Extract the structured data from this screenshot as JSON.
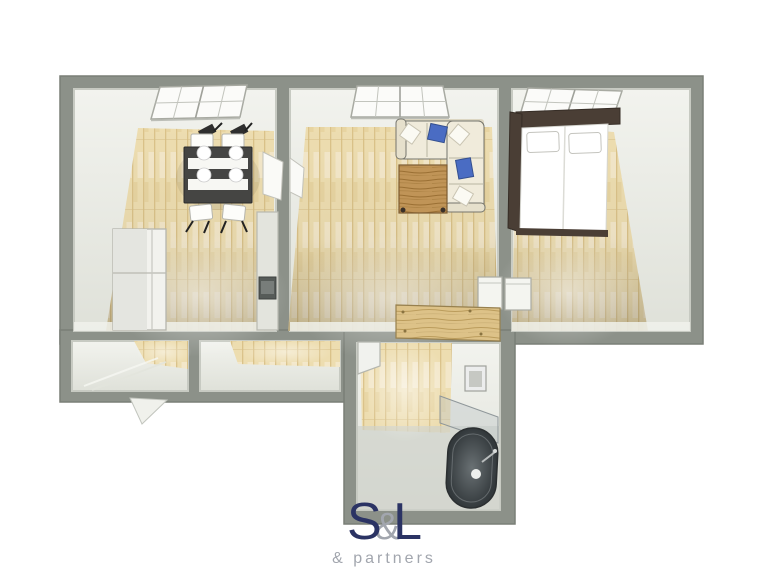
{
  "logo": {
    "s": "S",
    "amp": "&",
    "l": "L",
    "brand": "S&L",
    "tagline": "& partners"
  },
  "colors": {
    "wall": "#8c9189",
    "wall-edge": "#7a7f77",
    "wall-inner-line": "#c7cac2",
    "room": "#e9ebe4",
    "floor-wood": "#edddb0",
    "floor-wood-line": "#dac289",
    "bath-floor": "#cfd2cb",
    "sofa-cream": "#f0ebdb",
    "pillow-blue": "#4a6cc3",
    "coffee-table-wood": "#c09457",
    "sideboard-wood": "#ddc288",
    "bed-frame-brown": "#4a3e35",
    "dining-table-dark": "#454543",
    "tub-dark": "#33393c",
    "logo-navy": "#2b3364",
    "logo-gray": "#a2a6ae"
  },
  "floorplan": {
    "view": "top-down-3d-render",
    "rooms": [
      {
        "name": "kitchen-dining",
        "furniture": [
          "window",
          "dining-table",
          "four-chairs",
          "refrigerator",
          "tall-kitchen-unit",
          "door-leaf"
        ]
      },
      {
        "name": "living-room",
        "furniture": [
          "window",
          "corner-sofa",
          "blue-cushions",
          "white-cushions",
          "coffee-table",
          "console-table",
          "door-leaf"
        ]
      },
      {
        "name": "bedroom",
        "furniture": [
          "window",
          "window-pelmet",
          "double-bed",
          "two-pillows",
          "console-table"
        ]
      },
      {
        "name": "storage-left",
        "furniture": []
      },
      {
        "name": "storage-right",
        "furniture": []
      },
      {
        "name": "hallway",
        "furniture": [
          "wooden-sideboard"
        ]
      },
      {
        "name": "bathroom",
        "furniture": [
          "corner-shelf",
          "wall-sink",
          "glass-screen",
          "bathtub",
          "faucet"
        ]
      },
      {
        "name": "entrance",
        "furniture": [
          "open-door-leaf"
        ]
      }
    ]
  }
}
